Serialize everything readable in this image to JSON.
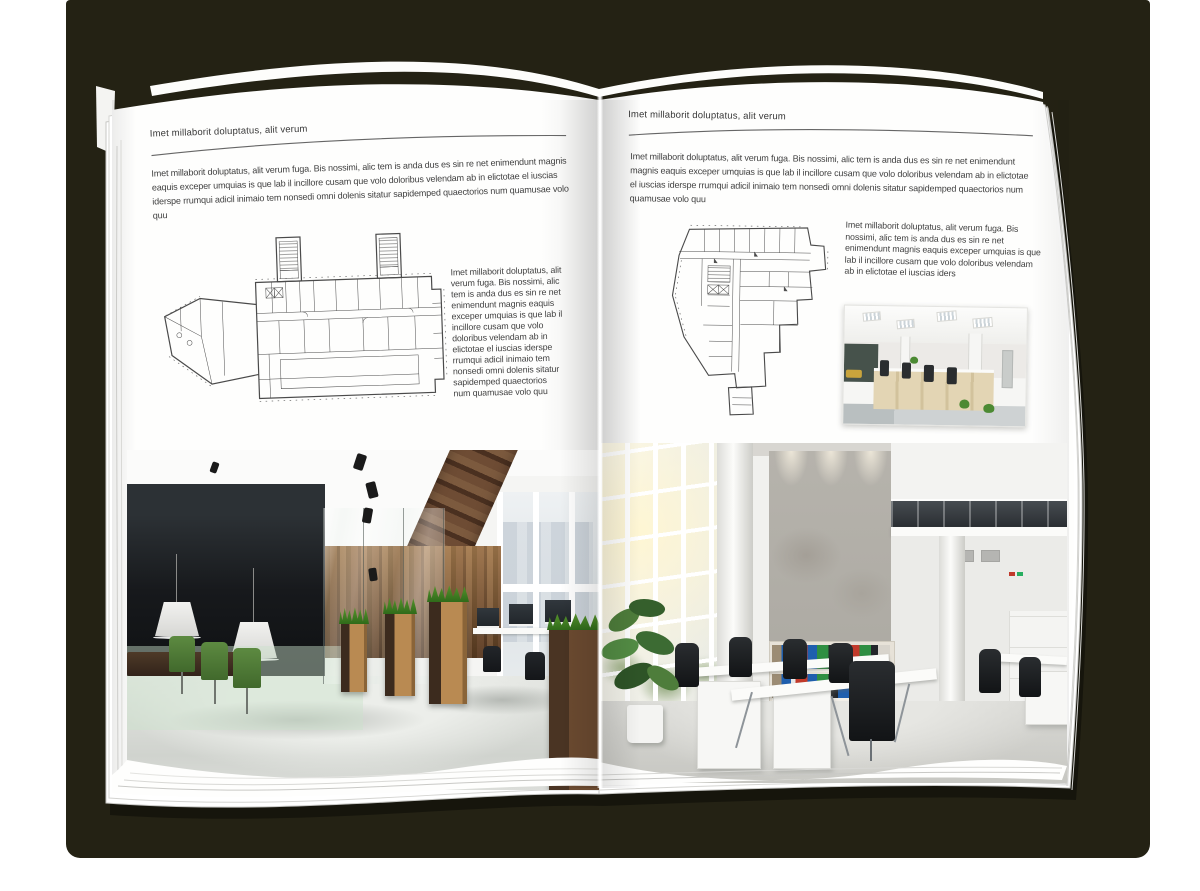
{
  "book": {
    "left_page": {
      "header": "Imet millaborit doluptatus, alit verum",
      "intro": "Imet millaborit doluptatus, alit verum fuga. Bis nossimi, alic tem is anda dus es sin re net enimendunt magnis eaquis exceper umquias is que lab il incillore cusam que volo doloribus velendam ab in elictotae el iuscias iderspe rrumqui adicil inimaio tem nonsedi omni dolenis sitatur sapidemped quaectorios num quamusae volo quu",
      "side_text": "Imet millaborit doluptatus, alit verum fuga. Bis nossimi, alic tem is anda dus es sin re net enimendunt magnis eaquis exceper umquias is que lab il incillore cusam que volo doloribus velendam ab in elictotae el iuscias iderspe rrumqui adicil inimaio tem nonsedi omni dolenis sitatur sapidemped quaectorios num quamusae volo quu"
    },
    "right_page": {
      "header": "Imet millaborit doluptatus, alit verum",
      "intro": "Imet millaborit doluptatus, alit verum fuga. Bis nossimi, alic tem is anda dus es sin re net enimendunt magnis eaquis exceper umquias is que lab il incillore cusam que volo doloribus velendam ab in elictotae el iuscias iderspe rrumqui adicil inimaio tem nonsedi omni dolenis sitatur sapidemped quaectorios num quamusae volo quu",
      "side_text": "Imet millaborit doluptatus, alit verum fuga. Bis nossimi, alic tem is anda dus es sin re net enimendunt magnis eaquis exceper umquias is que lab il incillore cusam que volo doloribus velendam ab in elictotae el iuscias iders"
    }
  },
  "colors": {
    "backdrop": "#242214",
    "page": "#ffffff",
    "body_text": "#3f3f3f",
    "rule_line": "#666666",
    "wood": "#6e4c34",
    "plant_green": "#4c8a33"
  }
}
